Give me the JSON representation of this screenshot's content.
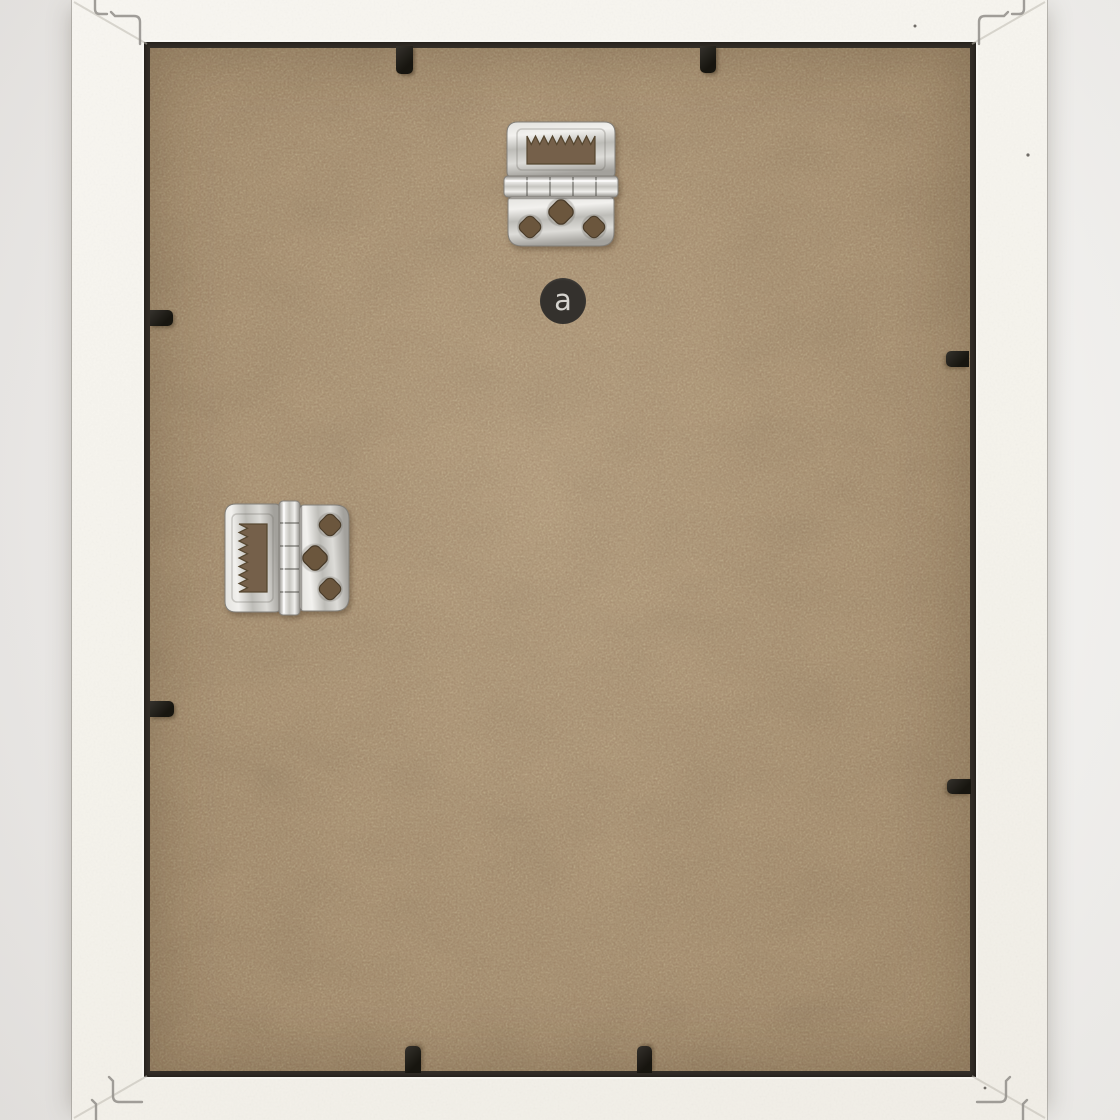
{
  "badge": {
    "letter": "a"
  },
  "colors": {
    "bg_left": "#e9e7e5",
    "bg_right": "#f2f1ef",
    "frame_light": "#f8f6f1",
    "frame_dark": "#f1eee7",
    "board_base": "#a48868",
    "recess_shadow": "#332e28",
    "clip_dark": "#17150f",
    "clip_light": "#35322d",
    "badge_bg": "#34312d",
    "badge_fg": "#d6d4cf",
    "mark_stroke": "#97948f",
    "metal_mid": "#c6c5c0"
  },
  "hardware": {
    "top_hanger": "sawtooth-hinged-hanger",
    "side_hanger": "sawtooth-hinged-hanger",
    "retainer_clip_count": 8
  }
}
